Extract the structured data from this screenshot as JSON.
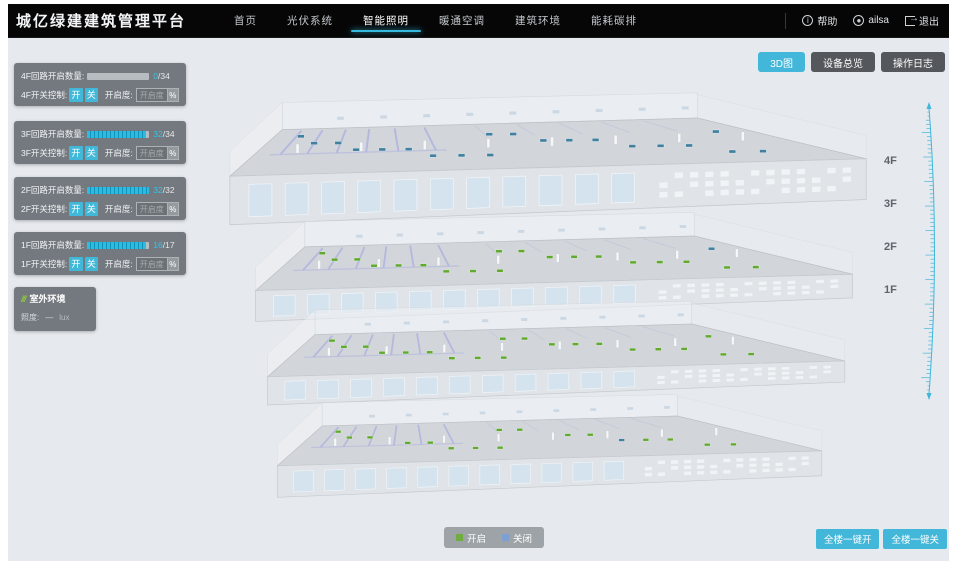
{
  "colors": {
    "accent": "#43b7d9",
    "marker_on": "#61a92f",
    "marker_off": "#41809e",
    "legend_on": "#6fae3e",
    "legend_off": "#7e9fd2"
  },
  "navbar": {
    "logo": "城亿绿建建筑管理平台",
    "items": [
      {
        "label": "首页"
      },
      {
        "label": "光伏系统"
      },
      {
        "label": "智能照明",
        "active": true
      },
      {
        "label": "暖通空调"
      },
      {
        "label": "建筑环境"
      },
      {
        "label": "能耗碳排"
      }
    ],
    "help": "帮助",
    "user": "ailsa",
    "logout": "退出",
    "help_icon_glyph": "i"
  },
  "view_buttons": [
    {
      "label": "3D图",
      "active": true
    },
    {
      "label": "设备总览"
    },
    {
      "label": "操作日志"
    }
  ],
  "floor_panels": [
    {
      "floor": "4F",
      "count_label": "4F回路开启数量:",
      "switch_label": "4F开关控制:",
      "open": 0,
      "total": 34
    },
    {
      "floor": "3F",
      "count_label": "3F回路开启数量:",
      "switch_label": "3F开关控制:",
      "open": 32,
      "total": 34
    },
    {
      "floor": "2F",
      "count_label": "2F回路开启数量:",
      "switch_label": "2F开关控制:",
      "open": 32,
      "total": 32
    },
    {
      "floor": "1F",
      "count_label": "1F回路开启数量:",
      "switch_label": "1F开关控制:",
      "open": 16,
      "total": 17
    }
  ],
  "panel_common": {
    "on": "开",
    "off": "关",
    "openness": "开启度:",
    "input_placeholder": "开启度",
    "percent": "%",
    "sep": "/"
  },
  "outdoor": {
    "title": "室外环境",
    "icon_glyph": "///",
    "metric": "照度:",
    "value": "—",
    "unit": "lux"
  },
  "floor_labels": [
    "4F",
    "3F",
    "2F",
    "1F"
  ],
  "legend": [
    {
      "label": "开启",
      "color": "#6fae3e"
    },
    {
      "label": "关闭",
      "color": "#7e9fd2"
    }
  ],
  "bulk_actions": [
    {
      "label": "全楼一键开"
    },
    {
      "label": "全楼一键关"
    }
  ]
}
